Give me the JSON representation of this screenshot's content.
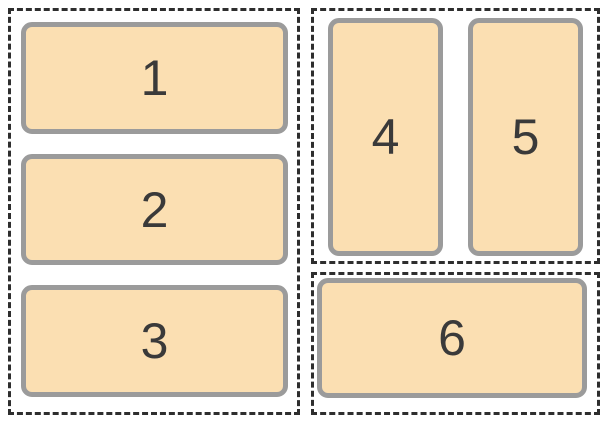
{
  "colors": {
    "canvas_bg": "#ffffff",
    "dash": "#2e2e2e",
    "box_fill": "#fbdfb2",
    "box_border": "#9b9b9b",
    "number_color": "#3a3a3a"
  },
  "groups": {
    "left": {
      "orientation": "vertical",
      "boxes": [
        {
          "label": "1"
        },
        {
          "label": "2"
        },
        {
          "label": "3"
        }
      ]
    },
    "right_top": {
      "orientation": "horizontal",
      "boxes": [
        {
          "label": "4"
        },
        {
          "label": "5"
        }
      ]
    },
    "right_bottom": {
      "orientation": "horizontal",
      "boxes": [
        {
          "label": "6"
        }
      ]
    }
  }
}
